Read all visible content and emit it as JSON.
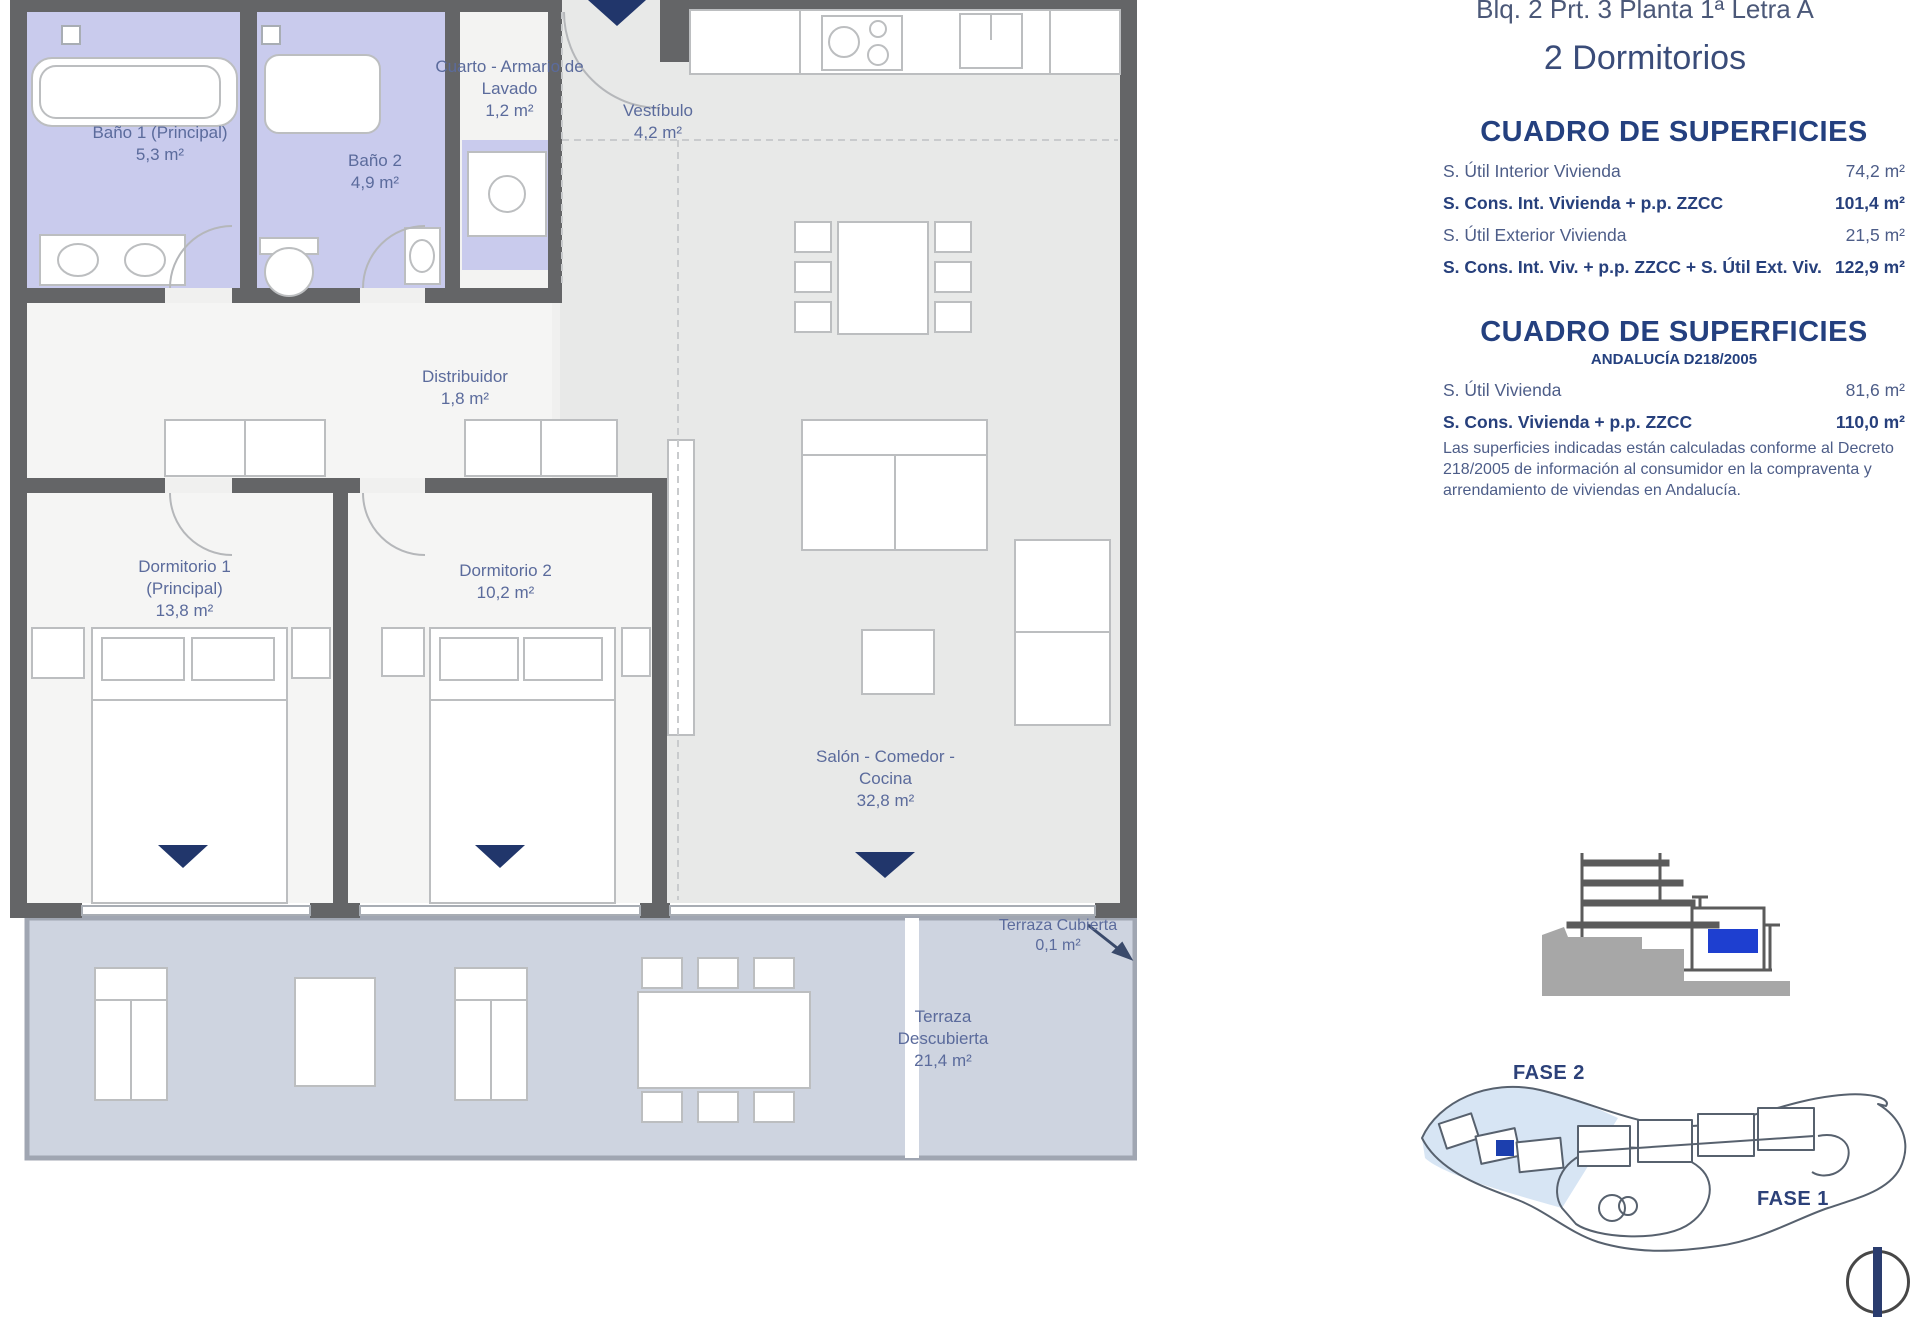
{
  "header": {
    "title": "Blq. 2 Prt. 3 Planta 1ª Letra A",
    "subtitle": "2 Dormitorios"
  },
  "surfaces_table": {
    "heading": "CUADRO DE SUPERFICIES",
    "rows": [
      {
        "label": "S. Útil Interior Vivienda",
        "value": "74,2 m²"
      },
      {
        "label": "S. Cons. Int. Vivienda + p.p. ZZCC",
        "value": "101,4 m²"
      },
      {
        "label": "S. Útil Exterior Vivienda",
        "value": "21,5 m²"
      },
      {
        "label": "S. Cons. Int. Viv. + p.p. ZZCC + S. Útil Ext. Viv.",
        "value": "122,9 m²"
      }
    ]
  },
  "surfaces_table_andalucia": {
    "heading": "CUADRO DE SUPERFICIES",
    "subheading": "ANDALUCÍA D218/2005",
    "rows": [
      {
        "label": "S. Útil Vivienda",
        "value": "81,6 m²"
      },
      {
        "label": "S. Cons. Vivienda + p.p. ZZCC",
        "value": "110,0 m²"
      }
    ],
    "note": "Las superficies indicadas están calculadas conforme al Decreto 218/2005 de información al consumidor en la compraventa y arrendamiento de viviendas en Andalucía."
  },
  "rooms": {
    "bano1": {
      "name": "Baño 1 (Principal)",
      "area": "5,3 m²"
    },
    "bano2": {
      "name": "Baño 2",
      "area": "4,9 m²"
    },
    "lavado": {
      "name": "Cuarto - Armario de Lavado",
      "area": "1,2 m²"
    },
    "vestibulo": {
      "name": "Vestíbulo",
      "area": "4,2 m²"
    },
    "distribuidor": {
      "name": "Distribuidor",
      "area": "1,8 m²"
    },
    "dormitorio1": {
      "name": "Dormitorio 1 (Principal)",
      "area": "13,8 m²"
    },
    "dormitorio2": {
      "name": "Dormitorio 2",
      "area": "10,2 m²"
    },
    "salon": {
      "name": "Salón - Comedor - Cocina",
      "area": "32,8 m²"
    },
    "terraza_cubierta": {
      "name": "Terraza Cubierta",
      "area": "0,1 m²"
    },
    "terraza_descubierta": {
      "name": "Terraza Descubierta",
      "area": "21,4 m²"
    }
  },
  "site_plan": {
    "fase2": "FASE 2",
    "fase1": "FASE 1"
  },
  "colors": {
    "accent_navy": "#27407c",
    "room_label_blue": "#5b6b9c",
    "wall_gray": "#646567",
    "bathroom_lavender": "#c9cbed",
    "terrace_bluegray": "#ced4e0",
    "fase2_highlight": "#d7e5f4",
    "unit_marker_blue": "#1e3fd0"
  }
}
